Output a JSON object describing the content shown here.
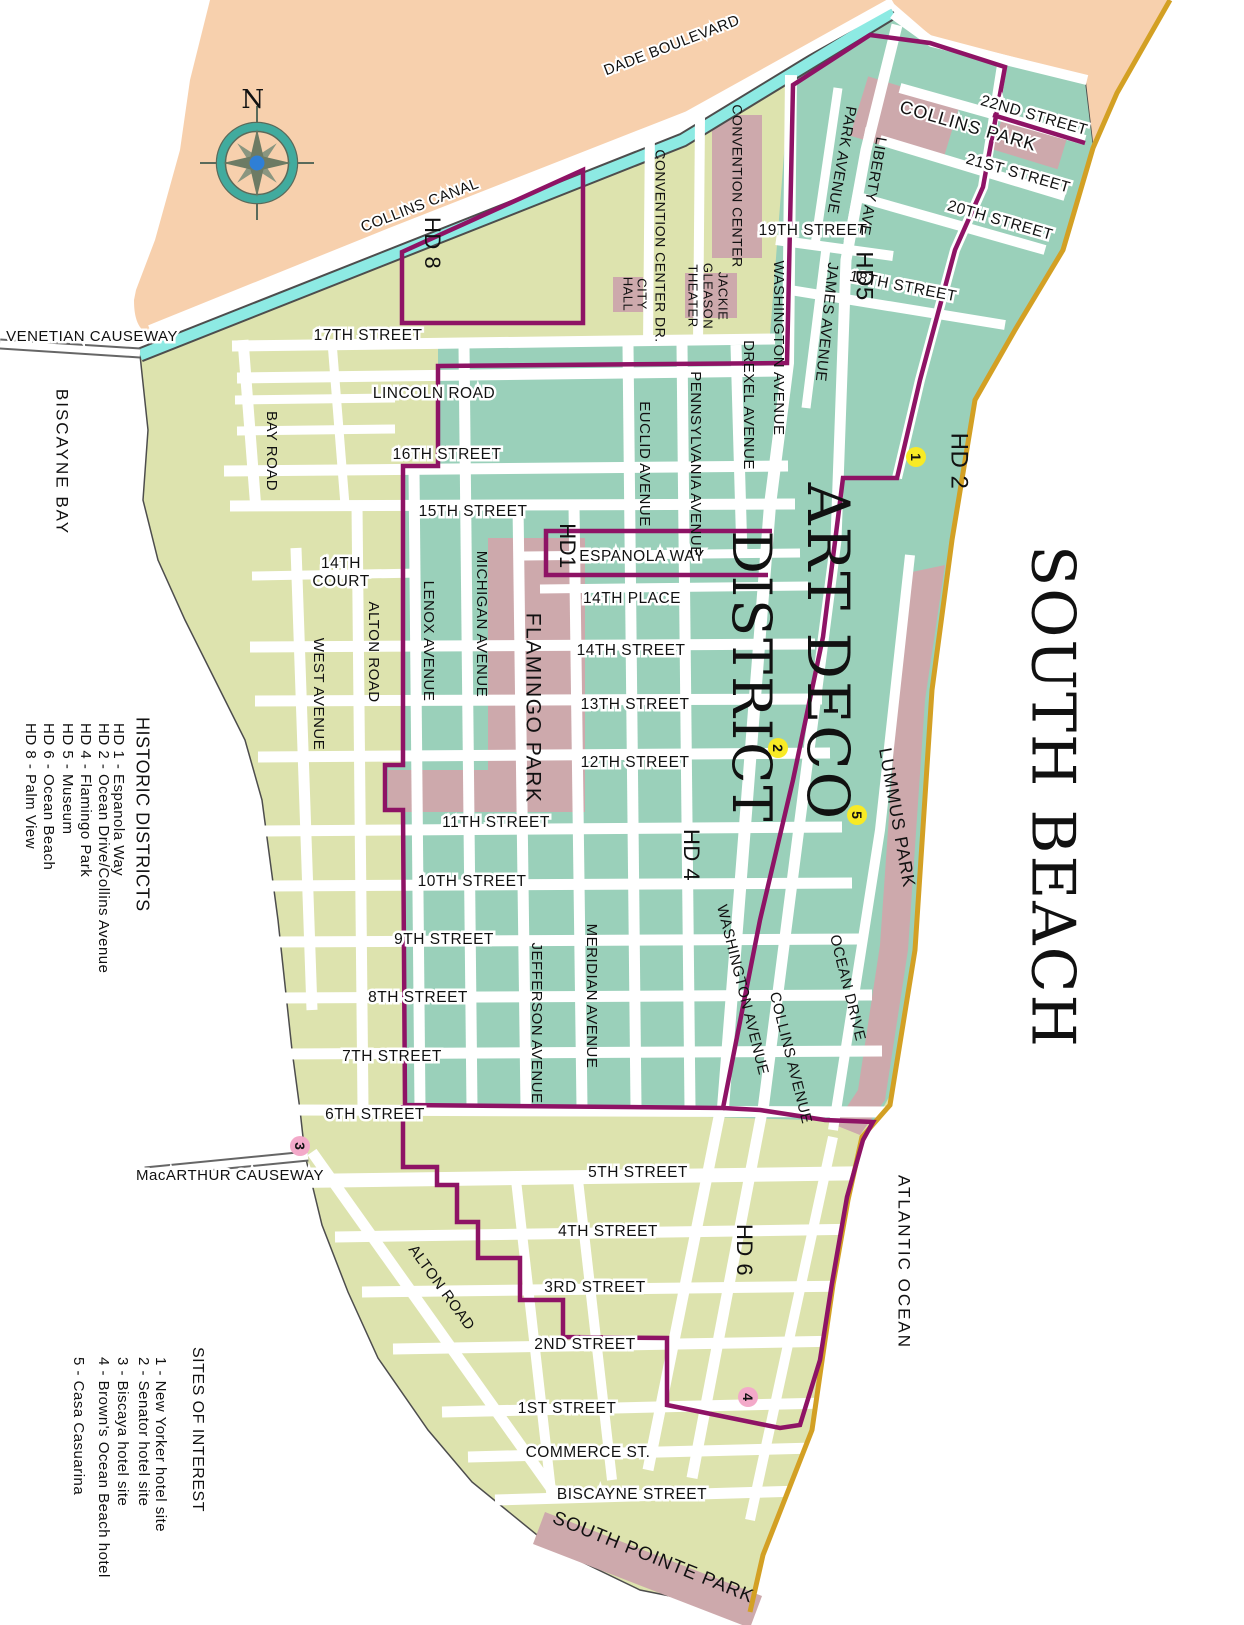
{
  "map_title": "SOUTH BEACH",
  "colors": {
    "mainland_peach": "#f7d0ad",
    "island_olive": "#dde3ae",
    "district_teal": "#9ad0ba",
    "park_pink": "#cda9ac",
    "canal_cyan": "#8deae3",
    "beach_gold": "#d3a024",
    "boundary_purple": "#8e1365",
    "road_white": "#ffffff",
    "shore_outline": "#4d4d4d",
    "marker_yellow": "#f8ea25",
    "marker_pink": "#f3a9c9",
    "compass_ring_teal": "#41ab9e",
    "compass_star_olive": "#6d7b64",
    "compass_center_blue": "#2f7fd6",
    "text": "#111111"
  },
  "labels": {
    "titles": [
      {
        "name": "title-south-beach",
        "text": "SOUTH BEACH",
        "x": 1048,
        "y": 797,
        "r": 90,
        "s": 60,
        "ls": 2,
        "f": "serif"
      },
      {
        "name": "title-art-deco-line1",
        "text": "ART DECO",
        "x": 823,
        "y": 652,
        "r": 90,
        "s": 58,
        "ls": 2,
        "f": "serif"
      },
      {
        "name": "title-art-deco-line2",
        "text": "DISTRICT",
        "x": 747,
        "y": 677,
        "r": 90,
        "s": 54,
        "ls": 2,
        "f": "serif"
      }
    ],
    "water": [
      {
        "name": "label-biscayne-bay",
        "text": "BISCAYNE BAY",
        "x": 61,
        "y": 462,
        "r": 90,
        "s": 17,
        "ls": 2
      },
      {
        "name": "label-atlantic-ocean",
        "text": "ATLANTIC OCEAN",
        "x": 903,
        "y": 1262,
        "r": 90,
        "s": 17,
        "ls": 2
      }
    ],
    "causeways": [
      {
        "name": "label-venetian-causeway",
        "text": "VENETIAN CAUSEWAY",
        "x": 92,
        "y": 337,
        "s": 15,
        "h": 5
      },
      {
        "name": "label-macarthur-causeway",
        "text": "MacARTHUR CAUSEWAY",
        "x": 230,
        "y": 1176,
        "s": 15,
        "h": 5
      },
      {
        "name": "label-collins-canal",
        "text": "COLLINS CANAL",
        "x": 420,
        "y": 206,
        "r": -21,
        "s": 15,
        "h": 4
      },
      {
        "name": "label-dade-boulevard",
        "text": "DADE BOULEVARD",
        "x": 672,
        "y": 46,
        "r": -21,
        "s": 15,
        "h": 4
      }
    ],
    "streets": [
      {
        "name": "label-17th-street",
        "text": "17TH STREET",
        "x": 368,
        "y": 336,
        "h": 5
      },
      {
        "name": "label-lincoln-road",
        "text": "LINCOLN ROAD",
        "x": 434,
        "y": 394,
        "h": 5
      },
      {
        "name": "label-16th-street",
        "text": "16TH STREET",
        "x": 447,
        "y": 455,
        "h": 5
      },
      {
        "name": "label-15th-street",
        "text": "15TH STREET",
        "x": 473,
        "y": 512,
        "h": 5
      },
      {
        "name": "label-espanola-way",
        "text": "ESPANOLA WAY",
        "x": 642,
        "y": 557,
        "h": 5
      },
      {
        "name": "label-14th-place",
        "text": "14TH PLACE",
        "x": 632,
        "y": 599,
        "h": 5
      },
      {
        "name": "label-14th-street",
        "text": "14TH STREET",
        "x": 631,
        "y": 651,
        "h": 5
      },
      {
        "name": "label-13th-street",
        "text": "13TH STREET",
        "x": 635,
        "y": 705,
        "h": 5
      },
      {
        "name": "label-12th-street",
        "text": "12TH STREET",
        "x": 635,
        "y": 763,
        "h": 5
      },
      {
        "name": "label-11th-street",
        "text": "11TH STREET",
        "x": 496,
        "y": 823,
        "h": 5
      },
      {
        "name": "label-10th-street",
        "text": "10TH STREET",
        "x": 472,
        "y": 882,
        "h": 5
      },
      {
        "name": "label-9th-street",
        "text": "9TH STREET",
        "x": 444,
        "y": 940,
        "h": 5
      },
      {
        "name": "label-8th-street",
        "text": "8TH STREET",
        "x": 418,
        "y": 998,
        "h": 5
      },
      {
        "name": "label-7th-street",
        "text": "7TH STREET",
        "x": 392,
        "y": 1057,
        "h": 5
      },
      {
        "name": "label-6th-street",
        "text": "6TH STREET",
        "x": 375,
        "y": 1115,
        "h": 5
      },
      {
        "name": "label-5th-street",
        "text": "5TH STREET",
        "x": 638,
        "y": 1173,
        "h": 5
      },
      {
        "name": "label-4th-street",
        "text": "4TH STREET",
        "x": 608,
        "y": 1232,
        "h": 5
      },
      {
        "name": "label-3rd-street",
        "text": "3RD STREET",
        "x": 595,
        "y": 1288,
        "h": 5
      },
      {
        "name": "label-2nd-street",
        "text": "2ND STREET",
        "x": 585,
        "y": 1345,
        "h": 5
      },
      {
        "name": "label-1st-street",
        "text": "1ST STREET",
        "x": 567,
        "y": 1409,
        "h": 5
      },
      {
        "name": "label-commerce-st",
        "text": "COMMERCE ST.",
        "x": 588,
        "y": 1453,
        "h": 5
      },
      {
        "name": "label-biscayne-street",
        "text": "BISCAYNE STREET",
        "x": 632,
        "y": 1495,
        "h": 5
      },
      {
        "name": "label-14th-court-line1",
        "text": "14TH",
        "x": 341,
        "y": 564,
        "h": 5
      },
      {
        "name": "label-14th-court-line2",
        "text": "COURT",
        "x": 341,
        "y": 582,
        "h": 5
      },
      {
        "name": "label-19th-street",
        "text": "19TH STREET",
        "x": 813,
        "y": 231,
        "h": 5
      },
      {
        "name": "label-18th-street",
        "text": "18TH STREET",
        "x": 903,
        "y": 287,
        "r": 11,
        "h": 5
      },
      {
        "name": "label-20th-street",
        "text": "20TH STREET",
        "x": 1000,
        "y": 221,
        "r": 16,
        "h": 5
      },
      {
        "name": "label-21st-street",
        "text": "21ST STREET",
        "x": 1018,
        "y": 174,
        "r": 16,
        "h": 5
      },
      {
        "name": "label-22nd-street",
        "text": "22ND STREET",
        "x": 1034,
        "y": 116,
        "r": 16,
        "h": 5
      }
    ],
    "avenues": [
      {
        "name": "label-bay-road",
        "text": "BAY ROAD",
        "x": 271,
        "y": 451,
        "r": 90,
        "s": 15
      },
      {
        "name": "label-west-avenue",
        "text": "WEST AVENUE",
        "x": 318,
        "y": 694,
        "r": 90,
        "s": 15
      },
      {
        "name": "label-alton-road-upper",
        "text": "ALTON ROAD",
        "x": 373,
        "y": 652,
        "r": 90,
        "s": 15
      },
      {
        "name": "label-lenox-avenue",
        "text": "LENOX AVENUE",
        "x": 428,
        "y": 641,
        "r": 90,
        "s": 15
      },
      {
        "name": "label-michigan-avenue",
        "text": "MICHIGAN AVENUE",
        "x": 481,
        "y": 624,
        "r": 90,
        "s": 15
      },
      {
        "name": "label-jefferson-avenue",
        "text": "JEFFERSON AVENUE",
        "x": 536,
        "y": 1023,
        "r": 90,
        "s": 15
      },
      {
        "name": "label-meridian-avenue",
        "text": "MERIDIAN AVENUE",
        "x": 591,
        "y": 996,
        "r": 90,
        "s": 15
      },
      {
        "name": "label-euclid-avenue",
        "text": "EUCLID AVENUE",
        "x": 644,
        "y": 464,
        "r": 90,
        "s": 15
      },
      {
        "name": "label-pennsylvania-avenue",
        "text": "PENNSYLVANIA AVENUE",
        "x": 695,
        "y": 464,
        "r": 90,
        "s": 15
      },
      {
        "name": "label-drexel-avenue",
        "text": "DREXEL AVENUE",
        "x": 748,
        "y": 405,
        "r": 90,
        "s": 15
      },
      {
        "name": "label-washington-avenue-upper",
        "text": "WASHINGTON AVENUE",
        "x": 778,
        "y": 348,
        "r": 90,
        "s": 15
      },
      {
        "name": "label-james-avenue",
        "text": "JAMES AVENUE",
        "x": 826,
        "y": 322,
        "r": 96,
        "s": 15
      },
      {
        "name": "label-park-avenue",
        "text": "PARK AVENUE",
        "x": 841,
        "y": 160,
        "r": 100,
        "s": 15
      },
      {
        "name": "label-liberty-ave",
        "text": "LIBERTY AVE",
        "x": 872,
        "y": 186,
        "r": 100,
        "s": 15
      },
      {
        "name": "label-washington-avenue-lower",
        "text": "WASHINGTON AVENUE",
        "x": 742,
        "y": 990,
        "r": 76,
        "s": 15
      },
      {
        "name": "label-collins-avenue",
        "text": "COLLINS AVENUE",
        "x": 790,
        "y": 1058,
        "r": 76,
        "s": 15
      },
      {
        "name": "label-ocean-drive",
        "text": "OCEAN DRIVE",
        "x": 847,
        "y": 988,
        "r": 76,
        "s": 15
      },
      {
        "name": "label-alton-road-lower",
        "text": "ALTON ROAD",
        "x": 441,
        "y": 1288,
        "r": 54,
        "s": 15
      }
    ],
    "parks": [
      {
        "name": "label-flamingo-park",
        "text": "FLAMINGO PARK",
        "x": 532,
        "y": 708,
        "r": 90,
        "s": 21,
        "ls": 1.5
      },
      {
        "name": "label-lummus-park",
        "text": "LUMMUS PARK",
        "x": 896,
        "y": 818,
        "r": 80,
        "s": 18,
        "ls": 1
      },
      {
        "name": "label-collins-park",
        "text": "COLLINS PARK",
        "x": 968,
        "y": 127,
        "r": 16,
        "s": 18,
        "ls": 1,
        "h": 4
      },
      {
        "name": "label-south-pointe-park",
        "text": "SOUTH POINTE PARK",
        "x": 653,
        "y": 1558,
        "r": 22,
        "s": 19,
        "ls": 1
      }
    ],
    "civic": [
      {
        "name": "label-convention-center",
        "text": "CONVENTION CENTER",
        "x": 736,
        "y": 186,
        "r": 90,
        "s": 14
      },
      {
        "name": "label-convention-center-dr",
        "text": "CONVENTION CENTER DR.",
        "x": 659,
        "y": 246,
        "r": 90,
        "s": 14
      },
      {
        "name": "label-city-hall-line1",
        "text": "CITY",
        "x": 641,
        "y": 294,
        "r": 90,
        "s": 13
      },
      {
        "name": "label-city-hall-line2",
        "text": "HALL",
        "x": 627,
        "y": 294,
        "r": 90,
        "s": 13
      },
      {
        "name": "label-jackie-gleason-line1",
        "text": "JACKIE",
        "x": 722,
        "y": 296,
        "r": 90,
        "s": 13
      },
      {
        "name": "label-jackie-gleason-line2",
        "text": "GLEASON",
        "x": 707,
        "y": 296,
        "r": 90,
        "s": 13
      },
      {
        "name": "label-jackie-gleason-line3",
        "text": "THEATER",
        "x": 692,
        "y": 296,
        "r": 90,
        "s": 13
      }
    ],
    "districts": [
      {
        "name": "label-hd8",
        "text": "HD 8",
        "x": 431,
        "y": 243,
        "r": 90,
        "s": 22
      },
      {
        "name": "label-hd5",
        "text": "HD5",
        "x": 863,
        "y": 276,
        "r": 90,
        "s": 24
      },
      {
        "name": "label-hd2",
        "text": "HD 2",
        "x": 958,
        "y": 461,
        "r": 90,
        "s": 24
      },
      {
        "name": "label-hd1",
        "text": "HD1",
        "x": 566,
        "y": 546,
        "r": 90,
        "s": 22
      },
      {
        "name": "label-hd4",
        "text": "HD 4",
        "x": 690,
        "y": 855,
        "r": 90,
        "s": 22
      },
      {
        "name": "label-hd6",
        "text": "HD 6",
        "x": 743,
        "y": 1250,
        "r": 90,
        "s": 22
      }
    ],
    "compass": [
      {
        "name": "compass-n-label",
        "text": "N",
        "x": 253,
        "y": 101,
        "s": 26,
        "f": "serif"
      }
    ],
    "legend_historic_districts": [
      {
        "name": "legend-historic-title",
        "text": "HISTORIC DISTRICTS",
        "x": 141,
        "y": 717,
        "r": 90,
        "s": 18,
        "a": "start"
      },
      {
        "name": "legend-hd1",
        "text": "HD 1 - Espanola Way",
        "x": 118,
        "y": 723,
        "r": 90,
        "s": 15,
        "a": "start"
      },
      {
        "name": "legend-hd2",
        "text": "HD 2 - Ocean Drive/Collins Avenue",
        "x": 103,
        "y": 723,
        "r": 90,
        "s": 15,
        "a": "start"
      },
      {
        "name": "legend-hd4",
        "text": "HD 4 - Flamingo Park",
        "x": 85,
        "y": 723,
        "r": 90,
        "s": 15,
        "a": "start"
      },
      {
        "name": "legend-hd5",
        "text": "HD 5 - Museum",
        "x": 67,
        "y": 723,
        "r": 90,
        "s": 15,
        "a": "start"
      },
      {
        "name": "legend-hd6",
        "text": "HD 6 - Ocean Beach",
        "x": 48,
        "y": 723,
        "r": 90,
        "s": 15,
        "a": "start"
      },
      {
        "name": "legend-hd8",
        "text": "HD 8 - Palm View",
        "x": 30,
        "y": 723,
        "r": 90,
        "s": 15,
        "a": "start"
      }
    ],
    "legend_sites_of_interest": [
      {
        "name": "legend-sites-title",
        "text": "SITES OF INTEREST",
        "x": 197,
        "y": 1347,
        "r": 90,
        "s": 16,
        "a": "start"
      },
      {
        "name": "legend-site1",
        "text": "1 - New Yorker hotel site",
        "x": 160,
        "y": 1357,
        "r": 90,
        "s": 15,
        "a": "start"
      },
      {
        "name": "legend-site2",
        "text": "2 - Senator hotel site",
        "x": 143,
        "y": 1357,
        "r": 90,
        "s": 15,
        "a": "start"
      },
      {
        "name": "legend-site3",
        "text": "3 - Biscaya hotel site",
        "x": 122,
        "y": 1357,
        "r": 90,
        "s": 15,
        "a": "start"
      },
      {
        "name": "legend-site4",
        "text": "4 - Brown's Ocean Beach hotel",
        "x": 103,
        "y": 1357,
        "r": 90,
        "s": 15,
        "a": "start"
      },
      {
        "name": "legend-site5",
        "text": "5 - Casa Casuarina",
        "x": 78,
        "y": 1357,
        "r": 90,
        "s": 15,
        "a": "start"
      }
    ]
  },
  "markers": [
    {
      "name": "site-marker-1",
      "num": "1",
      "x": 916,
      "y": 457,
      "color": "#f8ea25",
      "text_color": "#111111"
    },
    {
      "name": "site-marker-2",
      "num": "2",
      "x": 778,
      "y": 748,
      "color": "#f8ea25",
      "text_color": "#111111"
    },
    {
      "name": "site-marker-5",
      "num": "5",
      "x": 857,
      "y": 815,
      "color": "#f8ea25",
      "text_color": "#111111"
    },
    {
      "name": "site-marker-3",
      "num": "3",
      "x": 300,
      "y": 1146,
      "color": "#f3a9c9",
      "text_color": "#8e1365"
    },
    {
      "name": "site-marker-4",
      "num": "4",
      "x": 748,
      "y": 1397,
      "color": "#f3a9c9",
      "text_color": "#8e1365"
    }
  ]
}
